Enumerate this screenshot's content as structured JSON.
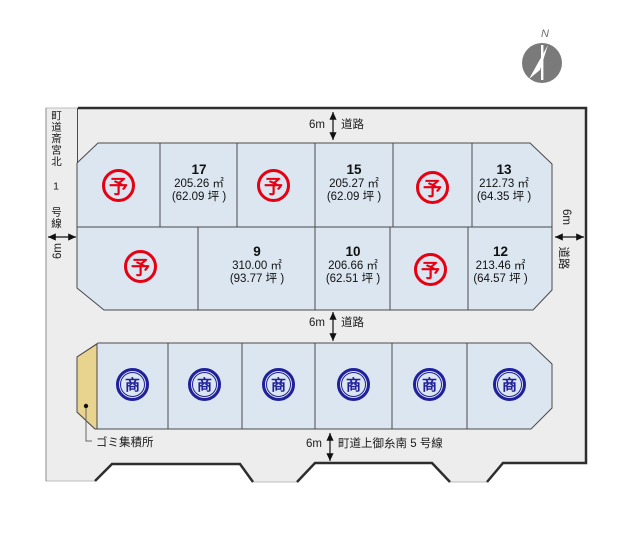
{
  "compass": {
    "north": "N"
  },
  "roads": {
    "top": {
      "width": "6m",
      "name": "道路"
    },
    "middle": {
      "width": "6m",
      "name": "道路"
    },
    "bottom": {
      "width": "6m",
      "name": "町道上御糸南 5 号線"
    },
    "left": {
      "width": "6m",
      "name": "町道斎宮北 1 号線"
    },
    "right": {
      "width": "6m",
      "name": "道路"
    }
  },
  "legend": {
    "reserved_mark": "予",
    "commercial_mark": "商"
  },
  "garbage_station_label": "ゴミ集積所",
  "lots": {
    "row1": [
      {
        "status": "reserved"
      },
      {
        "number": "17",
        "area": "205.26 ㎡",
        "tsubo": "(62.09 坪 )"
      },
      {
        "status": "reserved"
      },
      {
        "number": "15",
        "area": "205.27 ㎡",
        "tsubo": "(62.09 坪 )"
      },
      {
        "status": "reserved"
      },
      {
        "number": "13",
        "area": "212.73 ㎡",
        "tsubo": "(64.35 坪 )"
      }
    ],
    "row2": [
      {
        "status": "reserved"
      },
      {
        "number": "9",
        "area": "310.00 ㎡",
        "tsubo": "(93.77 坪 )"
      },
      {
        "number": "10",
        "area": "206.66 ㎡",
        "tsubo": "(62.51 坪 )"
      },
      {
        "status": "reserved"
      },
      {
        "number": "12",
        "area": "213.46 ㎡",
        "tsubo": "(64.57 坪 )"
      }
    ],
    "row3": [
      {
        "status": "commercial"
      },
      {
        "status": "commercial"
      },
      {
        "status": "commercial"
      },
      {
        "status": "commercial"
      },
      {
        "status": "commercial"
      },
      {
        "status": "commercial"
      }
    ]
  },
  "colors": {
    "map_background": "#ededed",
    "lot_fill": "#dbe6f1",
    "reserved_red": "#e60012",
    "commercial_navy": "#20209a",
    "garbage_tan": "#e8d48f"
  }
}
